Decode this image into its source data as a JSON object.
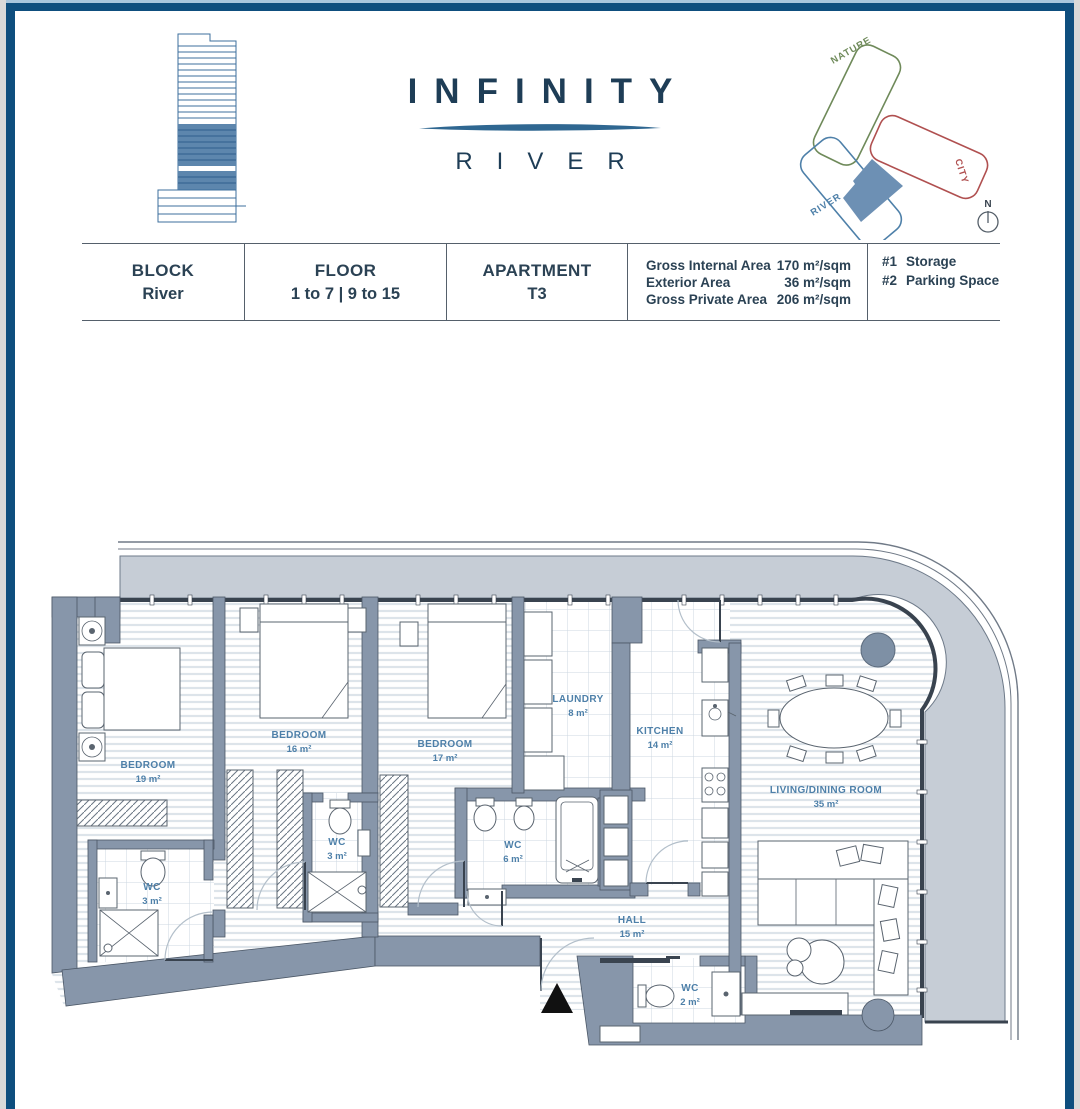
{
  "brand": {
    "title": "INFINITY",
    "subtitle": "RIVER"
  },
  "site_diagram": {
    "nature_label": "NATURE",
    "city_label": "CITY",
    "river_label": "RIVER",
    "compass": "N",
    "nature_color": "#6f8a5a",
    "city_color": "#b05050",
    "river_color": "#4e80a9",
    "unit_fill": "#6d90b4"
  },
  "info_table": {
    "block": {
      "label": "BLOCK",
      "value": "River"
    },
    "floor": {
      "label": "FLOOR",
      "value": "1 to 7 | 9 to 15"
    },
    "apartment": {
      "label": "APARTMENT",
      "value": "T3"
    },
    "areas": [
      {
        "label": "Gross Internal Area",
        "value": "170 m²/sqm"
      },
      {
        "label": "Exterior Area",
        "value": "36 m²/sqm"
      },
      {
        "label": "Gross Private Area",
        "value": "206 m²/sqm"
      }
    ],
    "extras": [
      {
        "label": "#1",
        "value": "Storage"
      },
      {
        "label": "#2",
        "value": "Parking Space"
      }
    ]
  },
  "floor_plan": {
    "rooms": [
      {
        "name": "BEDROOM",
        "area": "19 m²"
      },
      {
        "name": "BEDROOM",
        "area": "16 m²"
      },
      {
        "name": "BEDROOM",
        "area": "17 m²"
      },
      {
        "name": "LAUNDRY",
        "area": "8 m²"
      },
      {
        "name": "KITCHEN",
        "area": "14 m²"
      },
      {
        "name": "LIVING/DINING ROOM",
        "area": "35 m²"
      },
      {
        "name": "WC",
        "area": "3 m²"
      },
      {
        "name": "WC",
        "area": "3 m²"
      },
      {
        "name": "WC",
        "area": "6 m²"
      },
      {
        "name": "HALL",
        "area": "15 m²"
      },
      {
        "name": "WC",
        "area": "2 m²"
      }
    ],
    "colors": {
      "wall": "#8796aa",
      "terrace": "#c6cdd6",
      "label": "#4e80a9"
    }
  }
}
